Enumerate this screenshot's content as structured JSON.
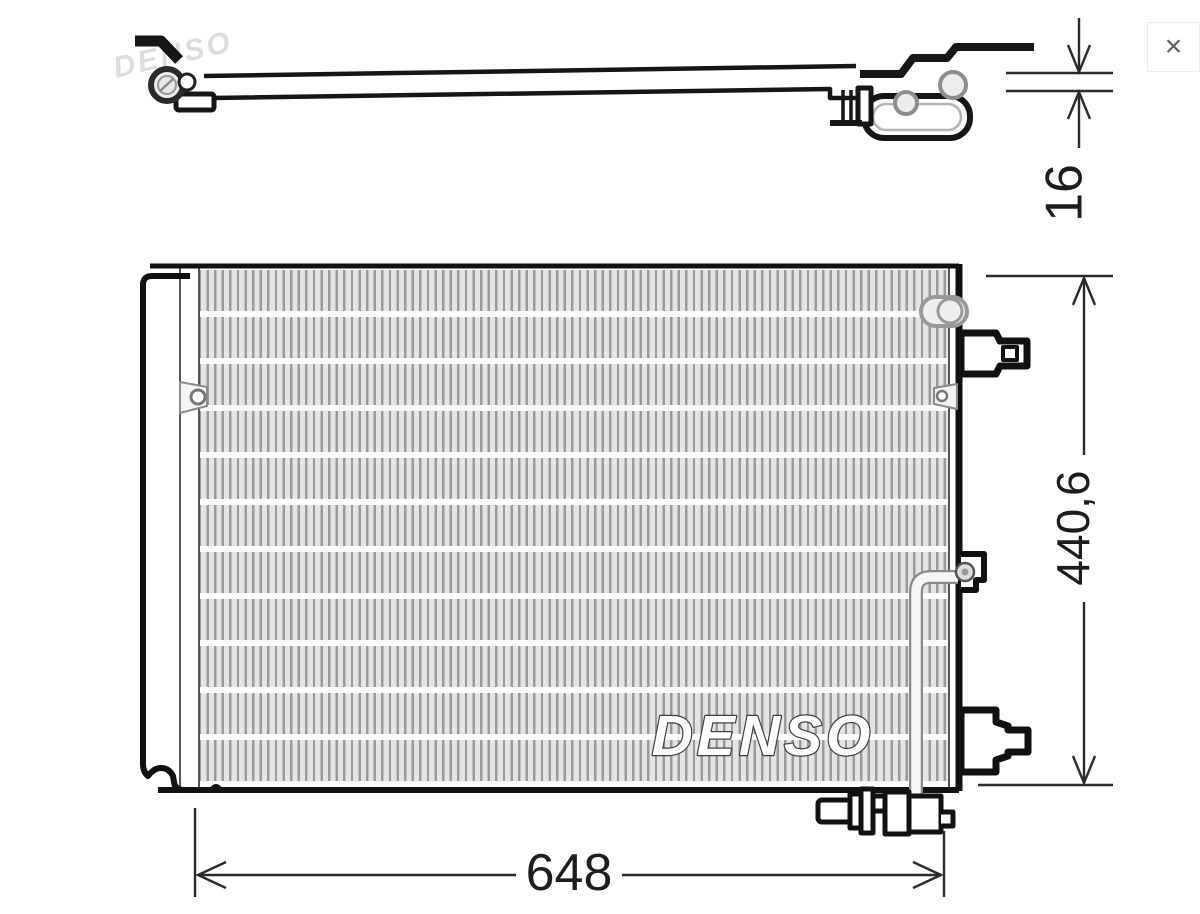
{
  "lightbox": {
    "close_icon": "×"
  },
  "drawing": {
    "title": "condenser technical drawing",
    "top_view": {
      "watermark": "DENSO"
    },
    "front_view": {
      "brand_logo": "DENSO"
    },
    "dimensions": {
      "thickness": "16",
      "height": "440,6",
      "width": "648"
    },
    "colors": {
      "outline": "#161616",
      "dimension_line": "#2a2a2a",
      "fin_gray": "#9a9a9a",
      "pipe_gray": "#8a8a8a",
      "watermark_gray": "#bdbdbd",
      "logo_outline": "#3f3f3f",
      "close_icon_gray": "#616161"
    }
  }
}
